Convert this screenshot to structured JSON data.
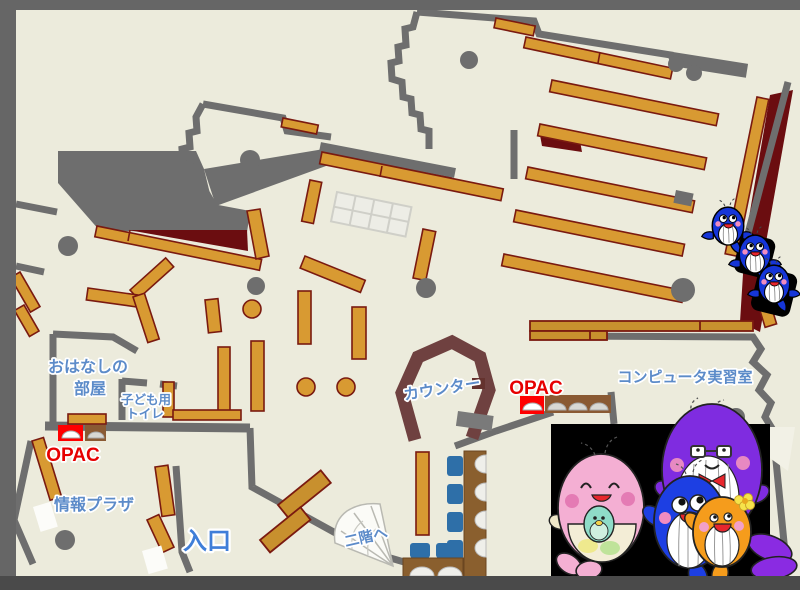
{
  "map": {
    "type": "library-floor-map",
    "labels": {
      "story_room": [
        "おはなしの",
        "部屋"
      ],
      "kids_toilet": [
        "子ども用",
        "トイレ"
      ],
      "opac_left": "OPAC",
      "info_plaza": "情報プラザ",
      "entrance": "入口",
      "stairs_up": "二階へ",
      "counter": "カウンター",
      "opac_center": "OPAC",
      "computer_room": "コンピュータ実習室"
    },
    "colors": {
      "floor": "#ECEBDC",
      "wall_gray": "#6E6E6E",
      "void_gray": "#6E6E6E",
      "shelf_tan": "#D89A32",
      "shelf_dark_tan": "#C8902E",
      "shelf_outline_red": "#7A1A10",
      "dark_red_area": "#6B0D10",
      "counter_maroon": "#6F4140",
      "desk_brown": "#8A5F2E",
      "chair_blue": "#2E6FA8",
      "opac_red": "#FF0000",
      "label_blue": "#5C8BC9",
      "label_red": "#E60000",
      "mascot_panel": "#000000"
    },
    "mascots": {
      "family_panel": [
        "pink-whale-mascot",
        "teal-baby-whale-mascot",
        "blue-whale-mascot",
        "purple-whale-mascot",
        "orange-whale-mascot"
      ],
      "wall_climbers": [
        "blue-whale-mascot",
        "blue-whale-mascot",
        "blue-whale-mascot"
      ]
    }
  }
}
